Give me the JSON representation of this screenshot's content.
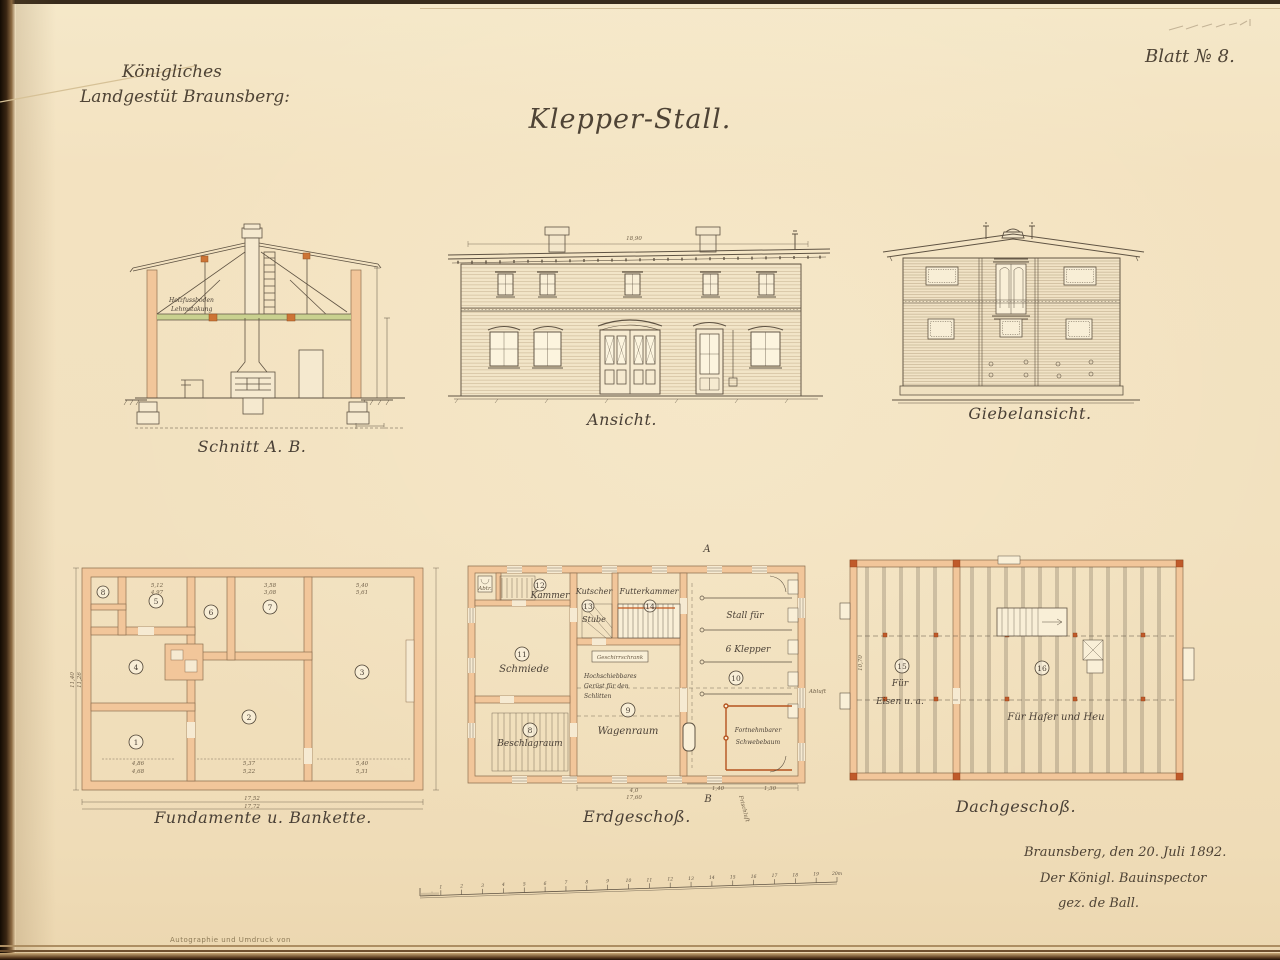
{
  "colors": {
    "paper": "#f2e1bf",
    "ink": "#4e4335",
    "wall_peach": "#f2c69a",
    "accent_orange": "#c0662c",
    "ceiling_green": "#c9d18f"
  },
  "page": {
    "header_line1": "Königliches",
    "header_line2": "Landgestüt Braunsberg:",
    "sheet_number": "Blatt № 8.",
    "title": "Klepper-Stall.",
    "imprint": "Autographie und Umdruck von",
    "signature_line1": "Braunsberg, den 20. Juli 1892.",
    "signature_line2": "Der Königl. Bauinspector",
    "signature_line3": "gez. de Ball."
  },
  "scalebar": {
    "ticks": [
      "1",
      "2",
      "3",
      "4",
      "5",
      "6",
      "7",
      "8",
      "9",
      "10",
      "11",
      "12",
      "13",
      "14",
      "15",
      "16",
      "17",
      "18",
      "19",
      "20m"
    ]
  },
  "schnitt": {
    "caption": "Schnitt A. B.",
    "label_floor": "Holzfussboden",
    "label_clay": "Lehmstakung"
  },
  "ansicht": {
    "caption": "Ansicht.",
    "dim_width": "18,90"
  },
  "giebel": {
    "caption": "Giebelansicht."
  },
  "fundamente": {
    "caption": "Fundamente u. Bankette.",
    "rooms": [
      "1",
      "2",
      "3",
      "4",
      "5",
      "6",
      "7",
      "8"
    ],
    "dims": {
      "bottom_1": "17,52",
      "bottom_2": "17,72",
      "left_1": "11,40",
      "left_2": "11,26",
      "r1_1": "4,86",
      "r1_2": "4,68",
      "r2_1": "5,37",
      "r2_2": "5,22",
      "r3_1": "5,40",
      "r3_2": "5,31",
      "t5_1": "5,12",
      "t5_2": "4,97",
      "t7_1": "3,58",
      "t7_2": "3,08",
      "t3_1": "5,40",
      "t3_2": "5,61"
    }
  },
  "erdgeschoss": {
    "caption": "Erdgeschoß.",
    "mark_a": "A",
    "mark_b": "B",
    "rooms": {
      "abtritt": "Abtr.",
      "kammer": "Kammer",
      "kammer_no": "12",
      "kutscher": "Kutscher",
      "stube": "Stube",
      "kutscher_no": "13",
      "futterkammer": "Futterkammer",
      "futter_no": "14",
      "stall_1": "Stall für",
      "stall_2": "6 Klepper",
      "stall_no": "10",
      "schmiede": "Schmiede",
      "schmiede_no": "11",
      "beschlagraum": "Beschlagraum",
      "beschlag_no": "8",
      "wagenraum": "Wagenraum",
      "wagen_no": "9",
      "geschirrschrank": "Geschirrschrank",
      "geruest_1": "Hochschiebbares",
      "geruest_2": "Gerüst für den",
      "geruest_3": "Schlitten",
      "schwebebaum_1": "Fortnehmbarer",
      "schwebebaum_2": "Schwebebaum",
      "abluft": "Abluft",
      "frischluft": "Frischluft"
    },
    "dims": {
      "b1": "4,0",
      "b2": "17,60",
      "r1": "1,40",
      "r2": "1,30"
    }
  },
  "dachgeschoss": {
    "caption": "Dachgeschoß.",
    "room15_no": "15",
    "room15_1": "Für",
    "room15_2": "Eisen u. a.",
    "room16_no": "16",
    "room16": "Für Hafer und Heu",
    "dim_left": "10,70"
  }
}
